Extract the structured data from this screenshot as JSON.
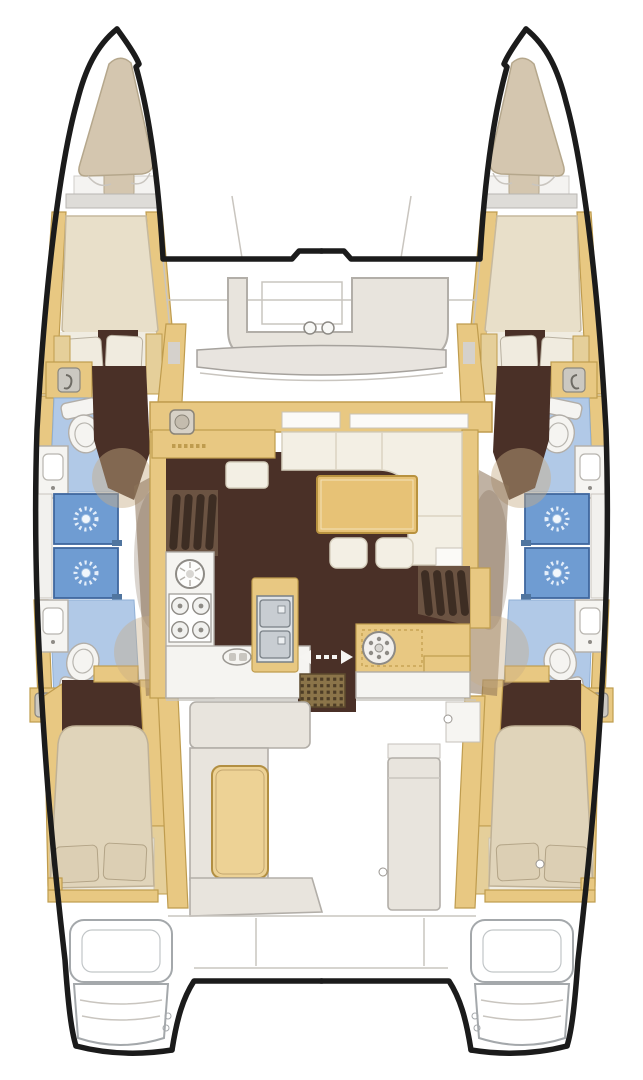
{
  "figure": {
    "kind": "boat-floor-plan",
    "view": "top-down",
    "vessel": "sailing catamaran (twin hulls, bridgedeck saloon)",
    "cabins": 4,
    "heads": 4,
    "showers": 4,
    "symmetry": "port / starboard mirrored"
  },
  "palette": {
    "outline": "#1b1b1b",
    "wood": "#e8c882",
    "wood_trim": "#bf9c4e",
    "wood_pale": "#e5cf9a",
    "table_wood": "#e7c276",
    "floor_dark": "#4a3027",
    "steps_brown": "#6b5342",
    "step_tread": "#3d2d23",
    "corridor_shade": "#8d7258",
    "blue_floor": "#b1c9e7",
    "blue_shower": "#6f9cd2",
    "drain_white": "#e4eefa",
    "cream": "#f3efe4",
    "bed_forward": "#e8dfc9",
    "bed_aft": "#e0d4ba",
    "pillow_white": "#f0ebdf",
    "pillow_beige": "#dccfb4",
    "bow_cushion": "#d4c6af",
    "cushion_gold": "#edd295",
    "gray_seat": "#e8e4dd",
    "fixture_white": "#f5f4f1",
    "steel": "#c8cdd2",
    "grate_base": "#8b7449",
    "grate_dot": "#4e3d26",
    "windshield": "#e8e4df"
  },
  "icons": [
    {
      "name": "shower-mixer-icon",
      "count": 4
    },
    {
      "name": "sunburst-drain-icon",
      "count": 4
    },
    {
      "name": "toilet",
      "count": 4
    },
    {
      "name": "washbasin",
      "count": 4
    },
    {
      "name": "round-galley-sink",
      "count": 1
    },
    {
      "name": "stove-burner",
      "count": 4
    },
    {
      "name": "double-steel-sink",
      "count": 1
    },
    {
      "name": "deck-hatch-wheel",
      "count": 1
    },
    {
      "name": "sliding-door-arrows",
      "count": 1
    },
    {
      "name": "cockpit-grate",
      "count": 1
    },
    {
      "name": "nav-instrument",
      "count": 1
    },
    {
      "name": "cupholder",
      "count": 2
    }
  ],
  "areas": {
    "bow": [
      "port bow locker cushion",
      "starboard bow locker cushion",
      "forward cockpit bench",
      "trampoline deck"
    ],
    "port_hull": [
      "forward island-bed cabin",
      "forward head with toilet and basin",
      "two shower stalls",
      "aft head with toilet and basin",
      "aft double cabin",
      "transom swim steps"
    ],
    "starboard_hull": [
      "forward island-bed cabin",
      "forward head with toilet and basin",
      "two shower stalls",
      "aft head with toilet and basin",
      "aft double cabin",
      "transom swim steps"
    ],
    "bridgedeck": [
      "chart table / nav station",
      "U-shaped saloon sofa",
      "saloon table",
      "two ottomans",
      "galley counter with stove and round sink",
      "double-sink island",
      "counter with hatch wheel",
      "port companionway steps",
      "starboard companionway steps",
      "sliding door to cockpit",
      "cockpit bench with cushion",
      "cockpit table",
      "aft deck and davits"
    ]
  }
}
